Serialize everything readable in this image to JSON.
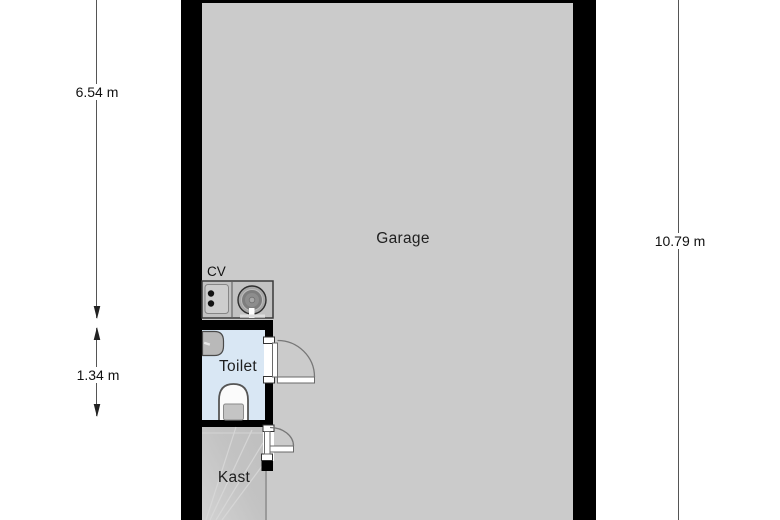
{
  "title": "Floor plan",
  "rooms": {
    "garage": {
      "label": "Garage"
    },
    "toilet": {
      "label": "Toilet"
    },
    "kast": {
      "label": "Kast"
    }
  },
  "fixtures": {
    "cv_label": "CV",
    "items": [
      "cv-boiler",
      "meter-panel",
      "hand-basin",
      "toilet-bowl",
      "staircase"
    ]
  },
  "dimensions": {
    "left_total": {
      "label": "6.54 m",
      "orientation": "vertical",
      "side": "left"
    },
    "left_toilet": {
      "label": "1.34 m",
      "orientation": "vertical",
      "side": "left"
    },
    "right_total": {
      "label": "10.79 m",
      "orientation": "vertical",
      "side": "right"
    }
  },
  "colors": {
    "background": "#ffffff",
    "wall": "#000000",
    "garage_floor": "#cbcbcb",
    "toilet_floor": "#d9e7f4",
    "kast_floor": "#c3c3c3",
    "dimension_line": "#555555",
    "door_arc": "#777777",
    "text": "#1a1a1a"
  }
}
